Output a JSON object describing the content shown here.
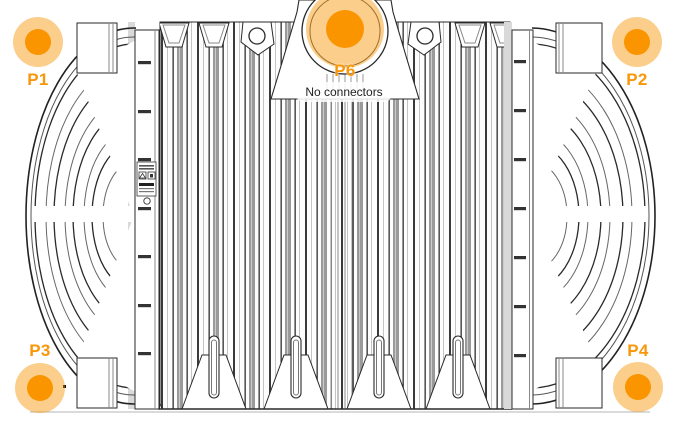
{
  "markers": {
    "p1": {
      "label": "P1"
    },
    "p2": {
      "label": "P2"
    },
    "p3": {
      "label": "P3"
    },
    "p4": {
      "label": "P4"
    },
    "p6": {
      "label": "P6",
      "note": "No connectors"
    }
  },
  "colors": {
    "marker_dot": "#FA9500",
    "marker_halo": "#FBCA85",
    "marker_label": "#F9970A",
    "drawing_line": "#2A2A2A",
    "note_text": "#222222",
    "note_background": "#FFFFFF"
  }
}
